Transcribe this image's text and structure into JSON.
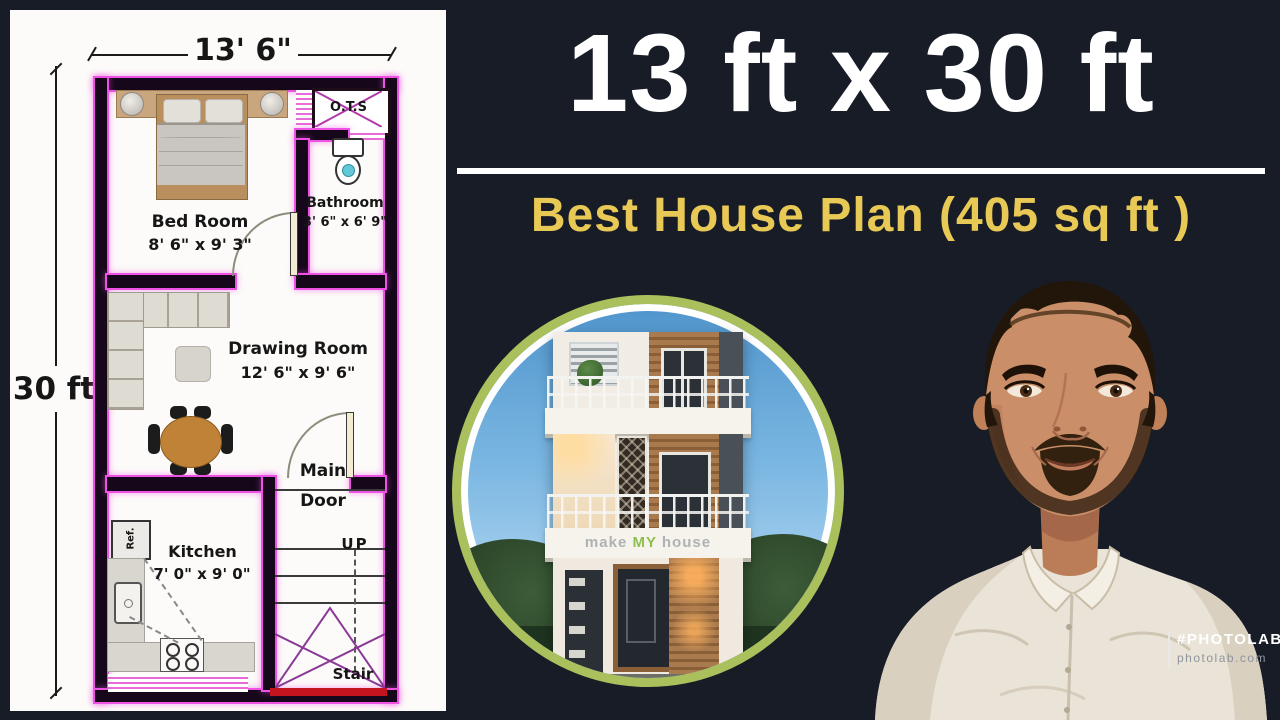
{
  "header": {
    "title": "13 ft x 30 ft",
    "subtitle": "Best House Plan (405 sq ft )"
  },
  "plan": {
    "top_dimension": "13' 6\"",
    "left_dimension": "30 ft",
    "bedroom_name": "Bed Room",
    "bedroom_dims": "8' 6\" x 9' 3\"",
    "ots_label": "O.T.S",
    "bathroom_name": "Bathroom",
    "bathroom_dims": "3' 6\" x 6' 9\"",
    "drawing_name": "Drawing Room",
    "drawing_dims": "12' 6\" x 9' 6\"",
    "main_door_line1": "Main",
    "main_door_line2": "Door",
    "kitchen_name": "Kitchen",
    "kitchen_dims": "7' 0\" x 9' 0\"",
    "ref_label": "Ref.",
    "up_label": "UP",
    "stair_label": "Stair"
  },
  "house_photo": {
    "brand_make": "make",
    "brand_my": "MY",
    "brand_house": "house"
  },
  "branding": {
    "hashtag": "#PHOTOLAB",
    "site": "photolab.com"
  },
  "colors": {
    "background": "#171c27",
    "wall": "#16081a",
    "magenta": "#ee52e4",
    "title_white": "#ffffff",
    "subtitle_yellow": "#e9c956",
    "red_sill": "#c41420",
    "ring_green": "#a9c05c"
  }
}
